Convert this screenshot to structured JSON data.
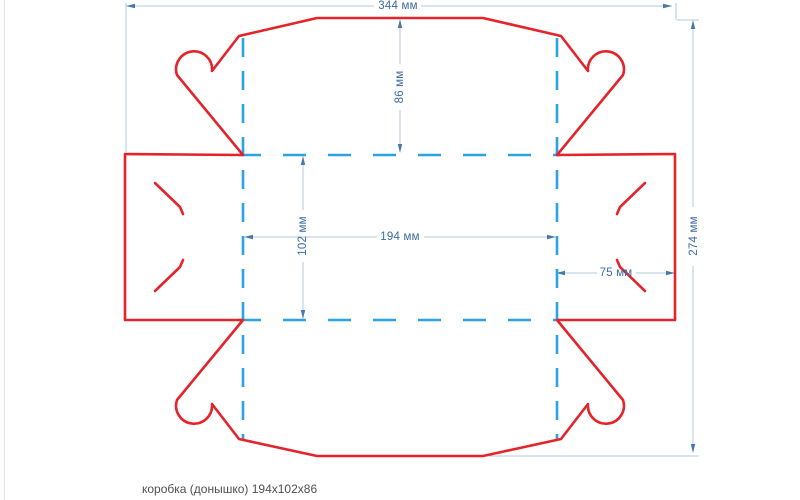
{
  "page": {
    "background": "#ffffff",
    "caption": "коробка (донышко) 194x102x86"
  },
  "drawing": {
    "kind": "box-dieline-bottom",
    "units": "мм",
    "colors": {
      "cut": "#e4232a",
      "fold": "#2aa3e2",
      "dim_line": "#b3c9dd",
      "dim_accent": "#4678aa",
      "dim_text": "#3c6ca2"
    },
    "dimensions": {
      "total_width": {
        "label": "344 мм",
        "value": 344
      },
      "total_height": {
        "label": "274 мм",
        "value": 274
      },
      "flap_top_height": {
        "label": "86 мм",
        "value": 86
      },
      "panel_height": {
        "label": "102 мм",
        "value": 102
      },
      "panel_width": {
        "label": "194 мм",
        "value": 194
      },
      "flap_side_width": {
        "label": "75 мм",
        "value": 75
      }
    }
  }
}
